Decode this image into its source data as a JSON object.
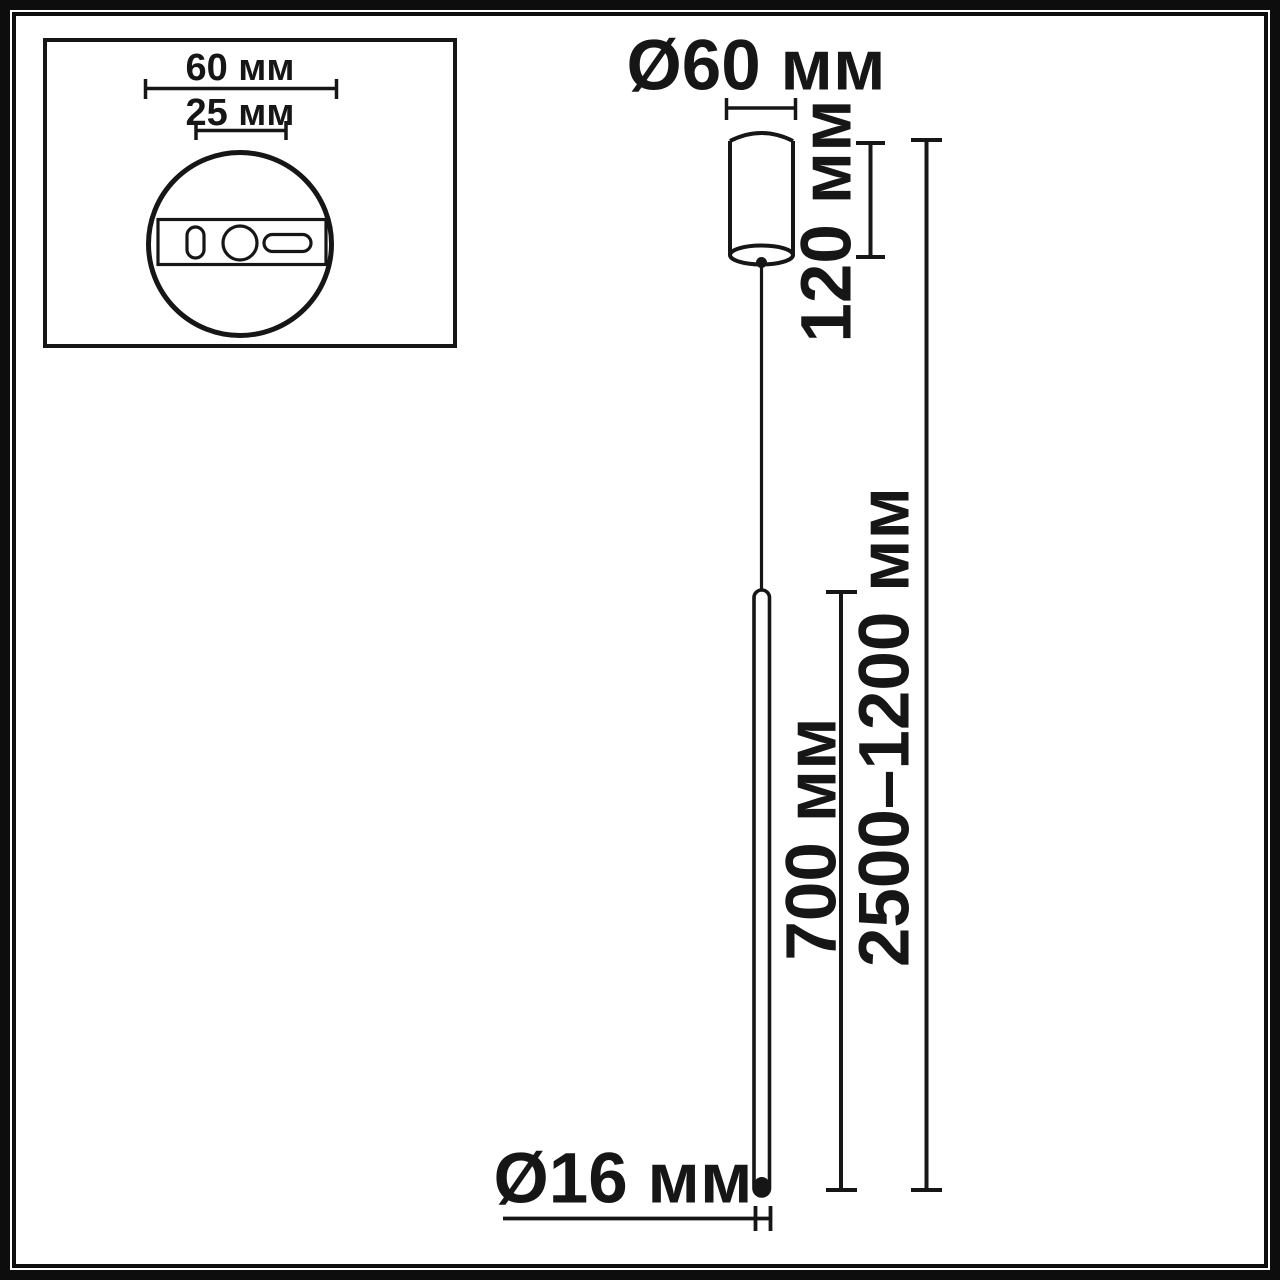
{
  "diagram_type": "pendant-light-dimension-drawing",
  "colors": {
    "line": "#161616",
    "background": "#ffffff"
  },
  "inset_view": {
    "description": "ceiling-mount-top-view",
    "outer_width_label": "60 мм",
    "hole_spacing_label": "25 мм"
  },
  "main_view": {
    "canopy_diameter_label": "Ø60 мм",
    "canopy_height_label": "120 мм",
    "lamp_length_label": "700 мм",
    "suspension_range_label": "2500–1200 мм",
    "tube_diameter_label": "Ø16 мм"
  }
}
